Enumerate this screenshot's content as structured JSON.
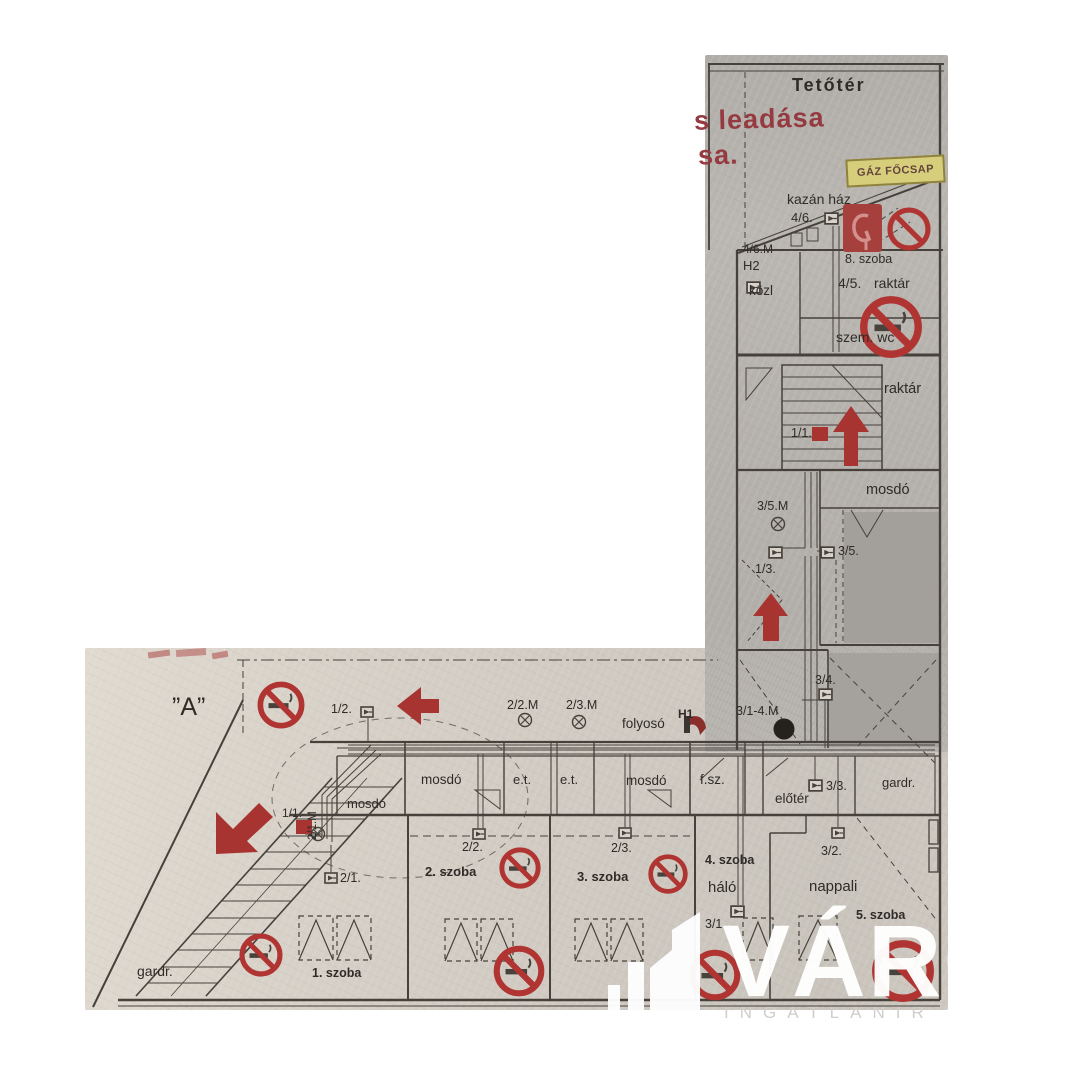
{
  "colors": {
    "accent_red": "#a83432",
    "stamp_red": "#953a40",
    "highlight_yellow": "#d7ce7c",
    "ink": "#46413b"
  },
  "watermark": {
    "brand": "VÁRO",
    "subtitle": "INGATLANIR"
  },
  "attic": {
    "title": "Tetőtér",
    "stamp_line1": "s leadása",
    "stamp_line2": "sa.",
    "gas_main_tag": "GÁZ FŐCSAP",
    "boiler_room": "kazán ház",
    "v46": "4/6.",
    "v46m": "4/6.M",
    "h2": "H2",
    "hall": "közl",
    "room8": "8. szoba",
    "v45": "4/5.",
    "storage_a": "raktár",
    "staff_wc": "szem. wc",
    "storage_b": "raktár",
    "v11": "1/1.",
    "washroom": "mosdó",
    "v35m": "3/5.M",
    "v13": "1/3.",
    "v35": "3/5.",
    "v34": "3/4.",
    "v314m": "3/1-4.M"
  },
  "ground": {
    "section_mark": "”A”",
    "v12": "1/2.",
    "v22m": "2/2.M",
    "v23m": "2/3.M",
    "corridor": "folyosó",
    "h1": "H1",
    "washroom_a": "mosdó",
    "washroom_b": "mosdó",
    "et_a": "e.t.",
    "et_b": "e.t.",
    "washroom_c": "mosdó",
    "fsz": "f.sz.",
    "foyer": "előtér",
    "v33": "3/3.",
    "wardrobe_r": "gardr.",
    "v21m": "2/1.M",
    "v11": "1/1.",
    "v21": "2/1.",
    "room2": "2. szoba",
    "v22": "2/2.",
    "v23": "2/3.",
    "room3": "3. szoba",
    "room4": "4. szoba",
    "bedroom": "háló",
    "v32": "3/2.",
    "living": "nappali",
    "v31": "3/1.",
    "room5": "5. szoba",
    "room1": "1. szoba",
    "wardrobe_l": "gardr."
  }
}
